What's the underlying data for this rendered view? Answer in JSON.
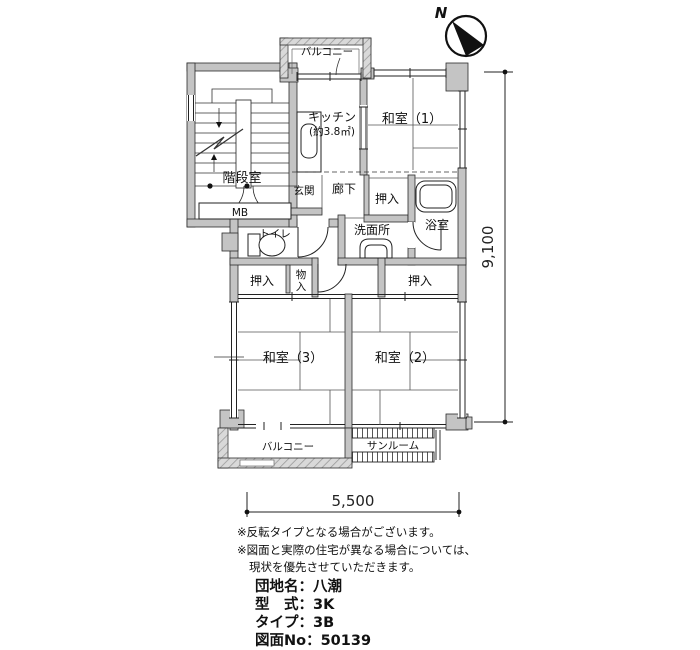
{
  "floor_plan": {
    "compass_n": "N",
    "rooms": {
      "balcony_top": "バルコニー",
      "kitchen1": "キッチン",
      "kitchen2": "(約3.8㎡)",
      "washitsu1": "和室（1）",
      "stairwell": "階段室",
      "mb": "MB",
      "entrance": "玄関",
      "hallway": "廊下",
      "closet_hall": "押入",
      "bath": "浴室",
      "washroom": "洗面所",
      "toilet": "トイレ",
      "closet_left": "押入",
      "storage1": "物",
      "storage2": "入",
      "closet_right": "押入",
      "washitsu3": "和室（3）",
      "washitsu2": "和室（2）",
      "balcony_bottom": "バルコニー",
      "sunroom": "サンルーム"
    },
    "dims": {
      "width": "5,500",
      "depth": "9,100"
    },
    "notes": [
      "※反転タイプとなる場合がございます。",
      "※図面と実際の住宅が異なる場合については、",
      "現状を優先させていただきます。"
    ],
    "info": [
      "団地名：八潮",
      "型　式：3K",
      "タイプ：3B",
      "図面No：50139"
    ],
    "colors": {
      "wall": "#c4c4c4",
      "line": "#1a1a1a",
      "background": "#ffffff"
    }
  }
}
